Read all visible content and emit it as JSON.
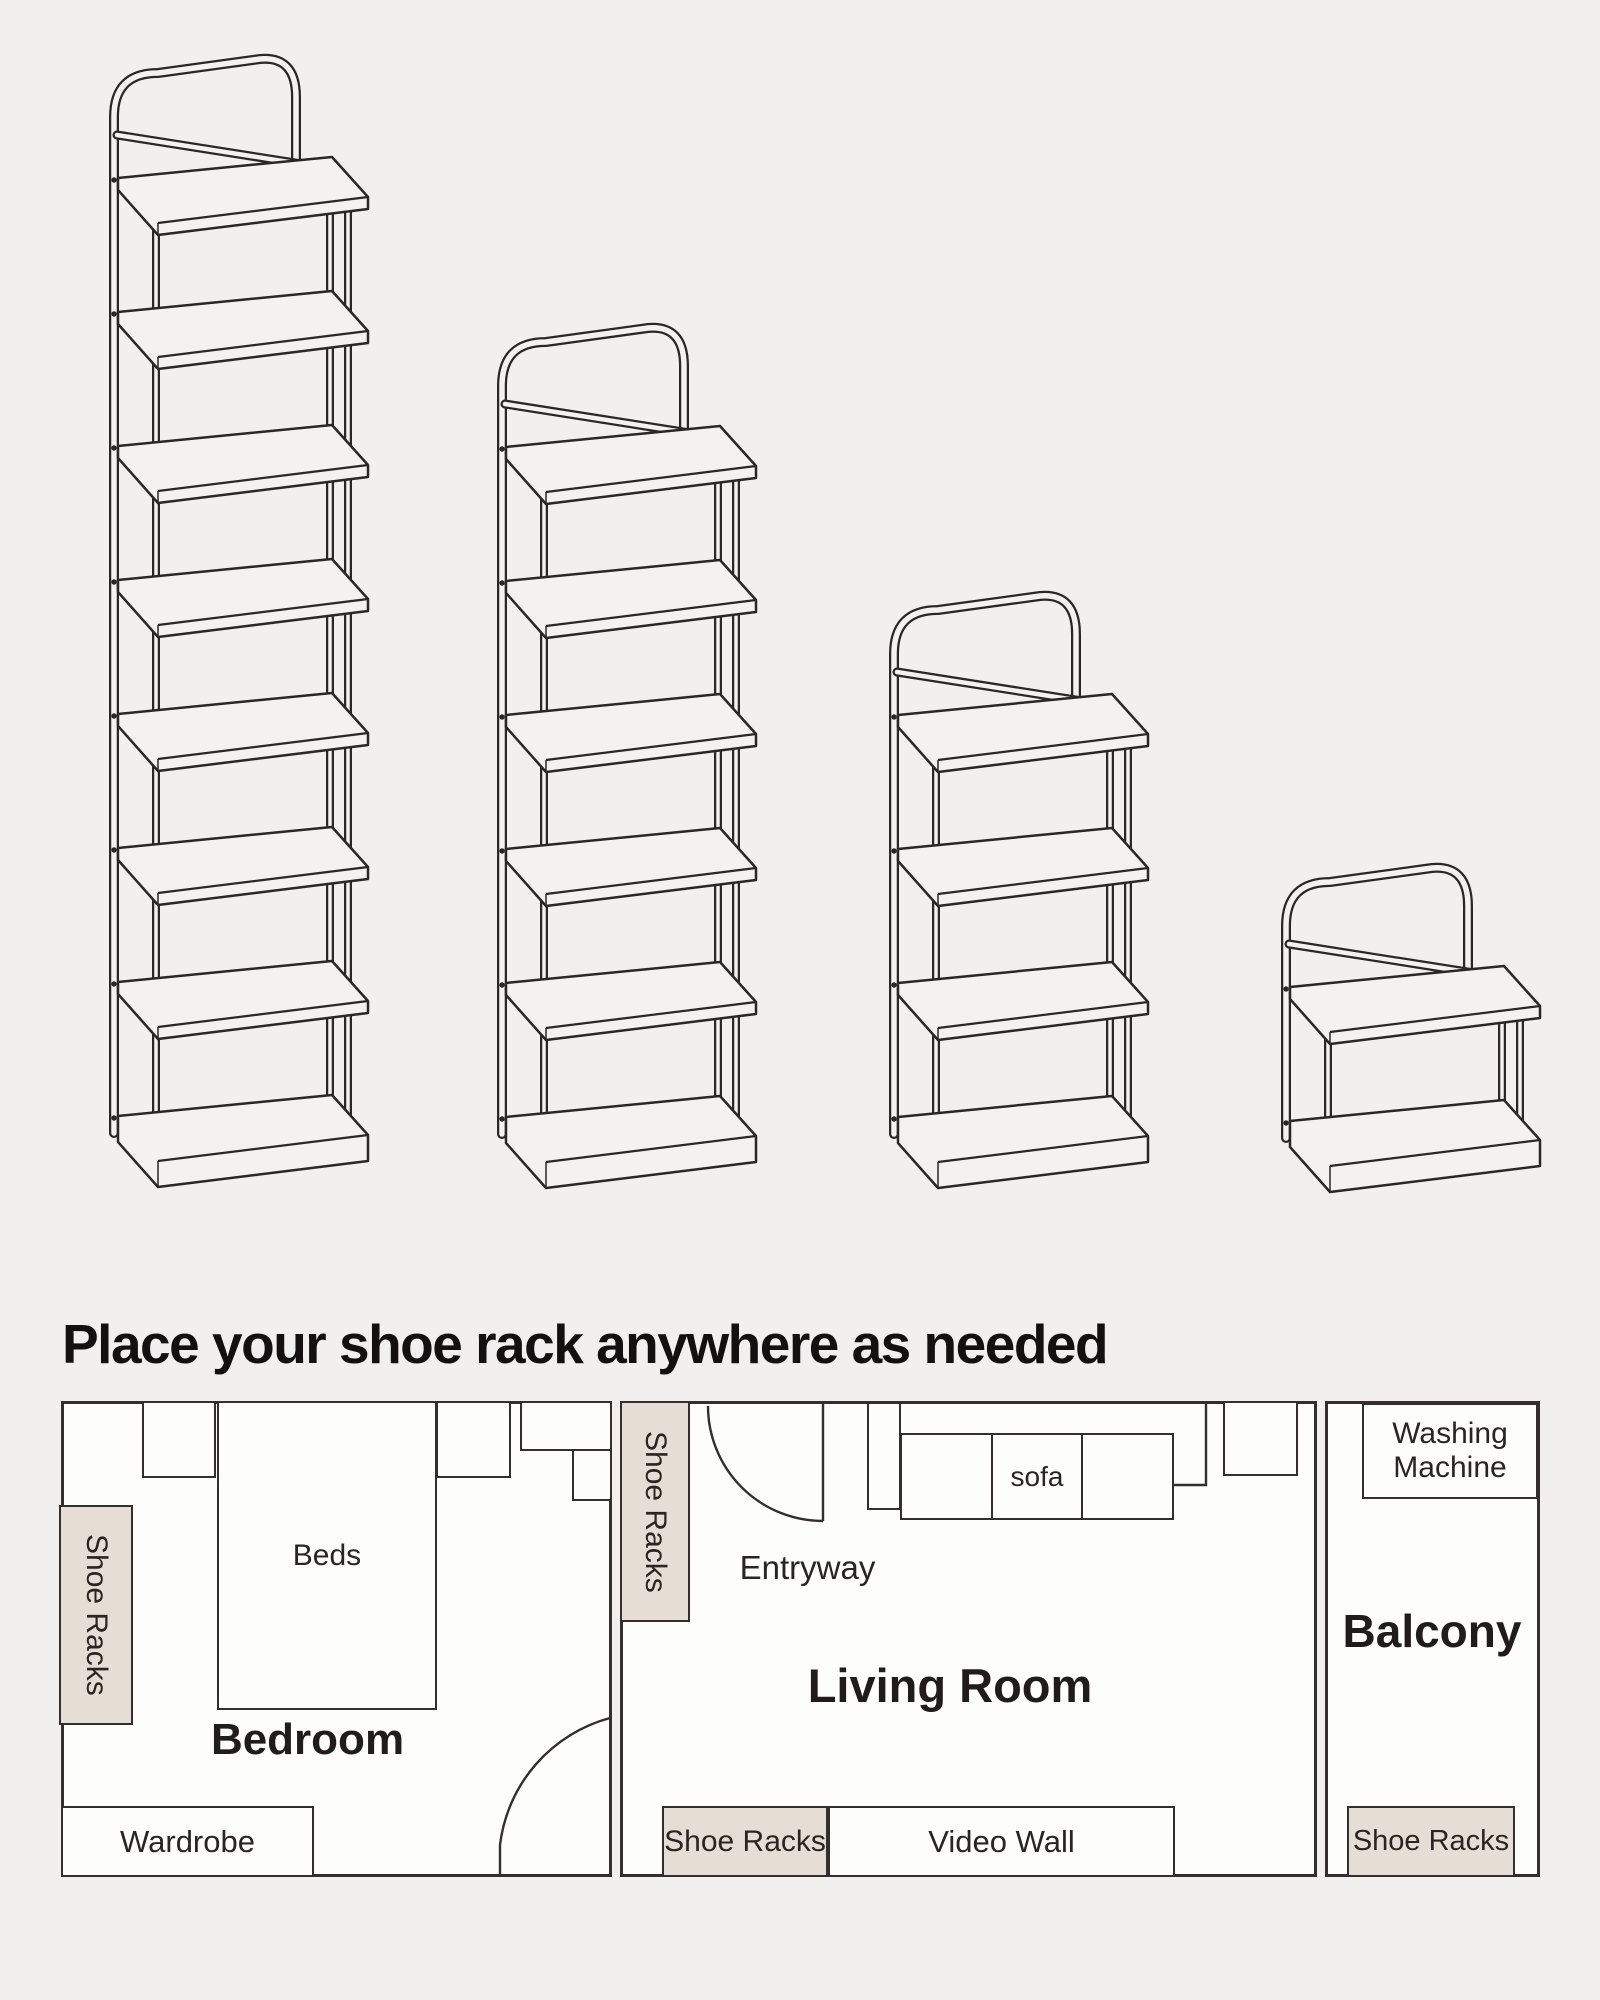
{
  "page": {
    "background": "#f1f0ee",
    "headline": "Place your shoe rack anywhere as needed",
    "headline_color": "#141011"
  },
  "illustration": {
    "description": "four shoe racks of descending heights",
    "line_color": "#2b2627",
    "board_fill": "#f3f2f0",
    "tier_spacing": 134,
    "racks": [
      {
        "name": "shoe-rack-8-tier",
        "tiers": 8,
        "x": 100,
        "top_shelf_y": 213
      },
      {
        "name": "shoe-rack-6-tier",
        "tiers": 6,
        "x": 488,
        "top_shelf_y": 482
      },
      {
        "name": "shoe-rack-4-tier",
        "tiers": 4,
        "x": 880,
        "top_shelf_y": 750
      },
      {
        "name": "shoe-rack-2-tier",
        "tiers": 2,
        "x": 1272,
        "top_shelf_y": 1022
      }
    ]
  },
  "plan": {
    "wall_color": "#352d2e",
    "accent_fill": "#e6ded4",
    "room_fill": "#fdfdfc",
    "bedroom": {
      "label": "Bedroom",
      "beds": "Beds",
      "wardrobe": "Wardrobe",
      "shoe_racks": "Shoe Racks"
    },
    "living_room": {
      "label": "Living Room",
      "entryway": "Entryway",
      "sofa": "sofa",
      "video_wall": "Video Wall",
      "shoe_racks_entry": "Shoe Racks",
      "shoe_racks_tv": "Shoe Racks"
    },
    "balcony": {
      "label": "Balcony",
      "washing_machine": "Washing Machine",
      "shoe_racks": "Shoe Racks"
    }
  }
}
